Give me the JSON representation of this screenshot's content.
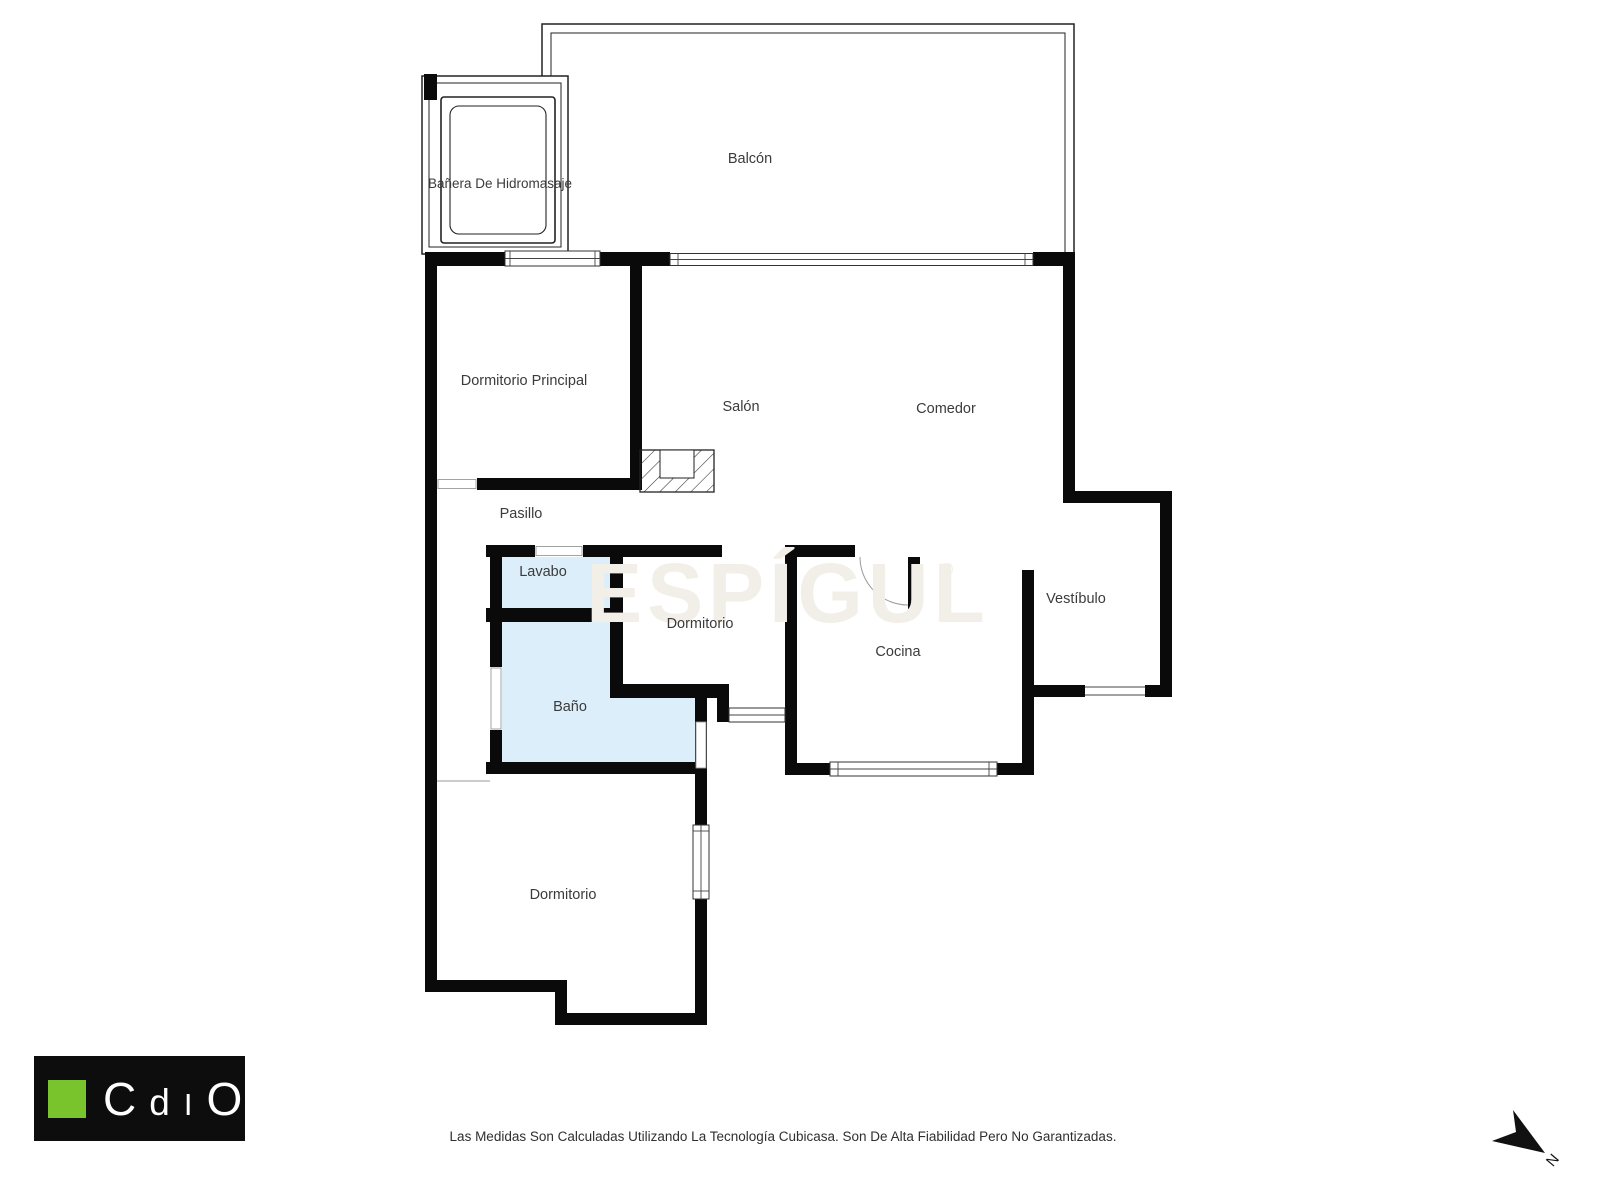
{
  "watermark": {
    "text": "ESPÍGUL",
    "registered_mark": "®"
  },
  "rooms": {
    "banera": "Bañera De Hidromasaje",
    "balcon": "Balcón",
    "dormitorio_principal": "Dormitorio Principal",
    "salon": "Salón",
    "comedor": "Comedor",
    "pasillo": "Pasillo",
    "lavabo": "Lavabo",
    "dormitorio_medio": "Dormitorio",
    "cocina": "Cocina",
    "vestibulo": "Vestíbulo",
    "bano": "Baño",
    "dormitorio_inferior": "Dormitorio"
  },
  "footer": {
    "disclaimer": "Las Medidas Son Calculadas Utilizando La Tecnología Cubicasa. Son De Alta Fiabilidad Pero No Garantizadas."
  },
  "logo": {
    "l1": "C",
    "l2": "d",
    "l3": "I",
    "l4": "O"
  },
  "compass": {
    "north": "N"
  },
  "colors": {
    "wall": "#0a0a0a",
    "wet_room": "#dceef9",
    "watermark": "#f2efe9",
    "label": "#3b3b3b",
    "logo_bg": "#0d0d0d",
    "logo_green": "#79c32d",
    "footer": "#2f2f2f"
  }
}
